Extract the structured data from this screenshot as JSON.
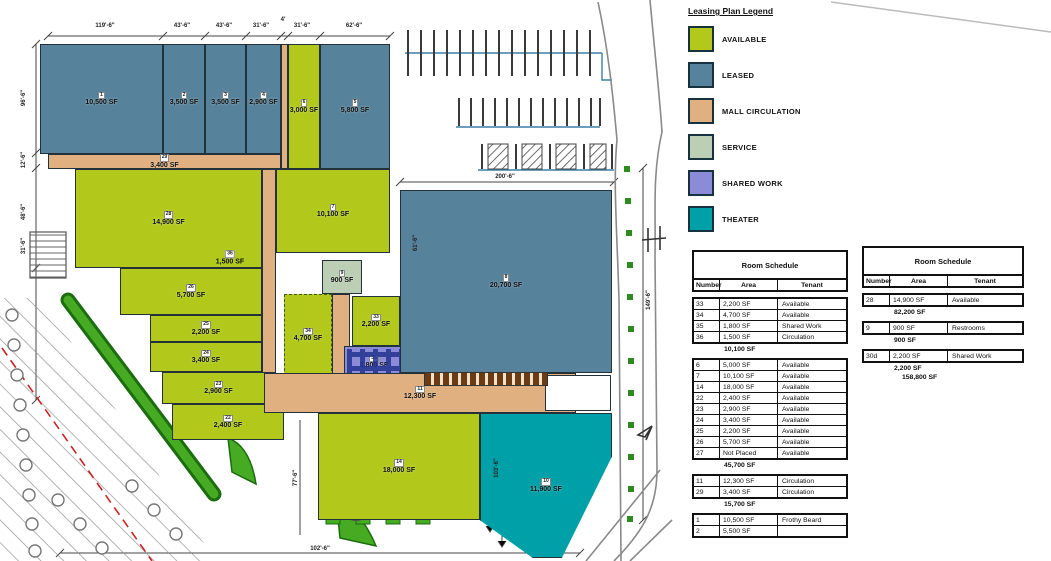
{
  "colors": {
    "available": "#b2c91c",
    "leased": "#57829b",
    "circulation": "#e0b080",
    "service": "#bccfb4",
    "shared": "#8b8bd8",
    "theater": "#00a0a8",
    "white": "#ffffff"
  },
  "legend": {
    "title": "Leasing Plan Legend",
    "items": [
      {
        "label": "AVAILABLE",
        "type": "available"
      },
      {
        "label": "LEASED",
        "type": "leased"
      },
      {
        "label": "MALL CIRCULATION",
        "type": "circulation"
      },
      {
        "label": "SERVICE",
        "type": "service"
      },
      {
        "label": "SHARED WORK",
        "type": "shared"
      },
      {
        "label": "THEATER",
        "type": "theater"
      }
    ]
  },
  "schedules": [
    {
      "title": "Room Schedule",
      "columns": [
        "Number",
        "Area",
        "Tenant"
      ],
      "pos": {
        "left": 692,
        "top": 250,
        "width": 156,
        "height": 311
      },
      "groups": [
        {
          "rows": [
            [
              "33",
              "2,200 SF",
              "Available"
            ],
            [
              "34",
              "4,700 SF",
              "Available"
            ],
            [
              "35",
              "1,800 SF",
              "Shared Work"
            ],
            [
              "36",
              "1,500 SF",
              "Circulation"
            ]
          ],
          "subtotal": "10,100 SF"
        },
        {
          "rows": [
            [
              "6",
              "5,000 SF",
              "Available"
            ],
            [
              "7",
              "10,100 SF",
              "Available"
            ],
            [
              "14",
              "18,000 SF",
              "Available"
            ],
            [
              "22",
              "2,400 SF",
              "Available"
            ],
            [
              "23",
              "2,900 SF",
              "Available"
            ],
            [
              "24",
              "3,400 SF",
              "Available"
            ],
            [
              "25",
              "2,200 SF",
              "Available"
            ],
            [
              "26",
              "5,700 SF",
              "Available"
            ],
            [
              "27",
              "Not Placed",
              "Available"
            ]
          ],
          "subtotal": "45,700 SF"
        },
        {
          "rows": [
            [
              "11",
              "12,300 SF",
              "Circulation"
            ],
            [
              "29",
              "3,400 SF",
              "Circulation"
            ]
          ],
          "subtotal": "15,700 SF"
        },
        {
          "rows": [
            [
              "1",
              "10,500 SF",
              "Frothy Beard"
            ],
            [
              "2",
              "5,500 SF",
              ""
            ]
          ],
          "subtotal": ""
        }
      ]
    },
    {
      "title": "Room Schedule",
      "columns": [
        "Number",
        "Area",
        "Tenant"
      ],
      "pos": {
        "left": 862,
        "top": 246,
        "width": 162,
        "height": 315
      },
      "groups": [
        {
          "rows": [
            [
              "28",
              "14,900 SF",
              "Available"
            ]
          ],
          "subtotal": "82,200 SF"
        },
        {
          "rows": [
            [
              "9",
              "900 SF",
              "Restrooms"
            ]
          ],
          "subtotal": "900 SF"
        },
        {
          "rows": [
            [
              "30d",
              "2,200 SF",
              "Shared Work"
            ]
          ],
          "subtotal": "2,200 SF",
          "total": "158,800 SF"
        }
      ]
    }
  ],
  "plan": {
    "units": [
      {
        "num": "1",
        "area": "10,500 SF",
        "type": "leased",
        "x": 40,
        "y": 44,
        "w": 123,
        "h": 110
      },
      {
        "num": "2",
        "area": "3,500 SF",
        "type": "leased",
        "x": 163,
        "y": 44,
        "w": 42,
        "h": 110
      },
      {
        "num": "3",
        "area": "3,500 SF",
        "type": "leased",
        "x": 205,
        "y": 44,
        "w": 41,
        "h": 110
      },
      {
        "num": "4",
        "area": "2,900 SF",
        "type": "leased",
        "x": 246,
        "y": 44,
        "w": 35,
        "h": 110
      },
      {
        "num": "",
        "area": "",
        "type": "circulation",
        "x": 281,
        "y": 44,
        "w": 7,
        "h": 125
      },
      {
        "num": "6",
        "area": "3,000 SF",
        "type": "available",
        "x": 288,
        "y": 44,
        "w": 32,
        "h": 125
      },
      {
        "num": "5",
        "area": "5,800 SF",
        "type": "leased",
        "x": 320,
        "y": 44,
        "w": 70,
        "h": 125
      },
      {
        "num": "29",
        "area": "3,400 SF",
        "type": "circulation",
        "x": 48,
        "y": 154,
        "w": 233,
        "h": 15
      },
      {
        "num": "28",
        "area": "14,900 SF",
        "type": "available",
        "x": 75,
        "y": 169,
        "w": 187,
        "h": 99
      },
      {
        "num": "",
        "area": "",
        "type": "circulation",
        "x": 262,
        "y": 169,
        "w": 14,
        "h": 206
      },
      {
        "num": "7",
        "area": "10,100 SF",
        "type": "available",
        "x": 276,
        "y": 169,
        "w": 114,
        "h": 84
      },
      {
        "num": "26",
        "area": "5,700 SF",
        "type": "available",
        "x": 120,
        "y": 268,
        "w": 142,
        "h": 47
      },
      {
        "num": "25",
        "area": "2,200 SF",
        "type": "available",
        "x": 150,
        "y": 315,
        "w": 112,
        "h": 27
      },
      {
        "num": "24",
        "area": "3,400 SF",
        "type": "available",
        "x": 150,
        "y": 342,
        "w": 112,
        "h": 30
      },
      {
        "num": "23",
        "area": "2,900 SF",
        "type": "available",
        "x": 162,
        "y": 372,
        "w": 113,
        "h": 32
      },
      {
        "num": "22",
        "area": "2,400 SF",
        "type": "available",
        "x": 172,
        "y": 404,
        "w": 112,
        "h": 36
      },
      {
        "num": "34",
        "area": "4,700 SF",
        "type": "available",
        "x": 284,
        "y": 294,
        "w": 48,
        "h": 82,
        "dashed": true
      },
      {
        "num": "9",
        "area": "900 SF",
        "type": "service",
        "x": 322,
        "y": 260,
        "w": 40,
        "h": 34
      },
      {
        "num": "",
        "area": "",
        "type": "circulation",
        "x": 332,
        "y": 294,
        "w": 18,
        "h": 82
      },
      {
        "num": "33",
        "area": "2,200 SF",
        "type": "available",
        "x": 352,
        "y": 296,
        "w": 48,
        "h": 50
      },
      {
        "num": "35",
        "area": "1,800 SF",
        "type": "shared",
        "x": 344,
        "y": 346,
        "w": 60,
        "h": 32
      },
      {
        "num": "8",
        "area": "20,700 SF",
        "type": "leased",
        "x": 400,
        "y": 190,
        "w": 212,
        "h": 183
      },
      {
        "num": "11",
        "area": "12,300 SF",
        "type": "circulation",
        "x": 264,
        "y": 373,
        "w": 312,
        "h": 40
      },
      {
        "num": "",
        "area": "",
        "type": "white",
        "x": 545,
        "y": 375,
        "w": 66,
        "h": 36
      },
      {
        "num": "14",
        "area": "18,000 SF",
        "type": "available",
        "x": 318,
        "y": 413,
        "w": 162,
        "h": 107
      },
      {
        "num": "10",
        "area": "11,900 SF",
        "type": "theater",
        "x": 480,
        "y": 413,
        "w": 132,
        "h": 145,
        "clip": "polygon(0 0,100% 0,100% 30%,62% 100%,40% 100%,0 74%)"
      }
    ],
    "floating_labels": [
      {
        "num": "36",
        "text": "1,500 SF",
        "x": 230,
        "y": 257
      }
    ],
    "dimensions": [
      {
        "text": "119'-6\"",
        "x": 105,
        "y": 26
      },
      {
        "text": "43'-6\"",
        "x": 182,
        "y": 26
      },
      {
        "text": "43'-6\"",
        "x": 224,
        "y": 26
      },
      {
        "text": "31'-6\"",
        "x": 261,
        "y": 26
      },
      {
        "text": "4'",
        "x": 283,
        "y": 20
      },
      {
        "text": "31'-6\"",
        "x": 302,
        "y": 26
      },
      {
        "text": "62'-6\"",
        "x": 354,
        "y": 26
      },
      {
        "text": "96'-6\"",
        "x": 24,
        "y": 98,
        "v": true
      },
      {
        "text": "12'-6\"",
        "x": 24,
        "y": 160,
        "v": true
      },
      {
        "text": "48'-6\"",
        "x": 24,
        "y": 212,
        "v": true
      },
      {
        "text": "31'-6\"",
        "x": 24,
        "y": 246,
        "v": true
      },
      {
        "text": "200'-6\"",
        "x": 505,
        "y": 177
      },
      {
        "text": "61'-6\"",
        "x": 416,
        "y": 243,
        "v": true
      },
      {
        "text": "149'-6\"",
        "x": 649,
        "y": 300,
        "v": true
      },
      {
        "text": "77'-6\"",
        "x": 296,
        "y": 478,
        "v": true
      },
      {
        "text": "103'-6\"",
        "x": 497,
        "y": 468,
        "v": true
      },
      {
        "text": "102'-6\"",
        "x": 320,
        "y": 549
      }
    ]
  }
}
